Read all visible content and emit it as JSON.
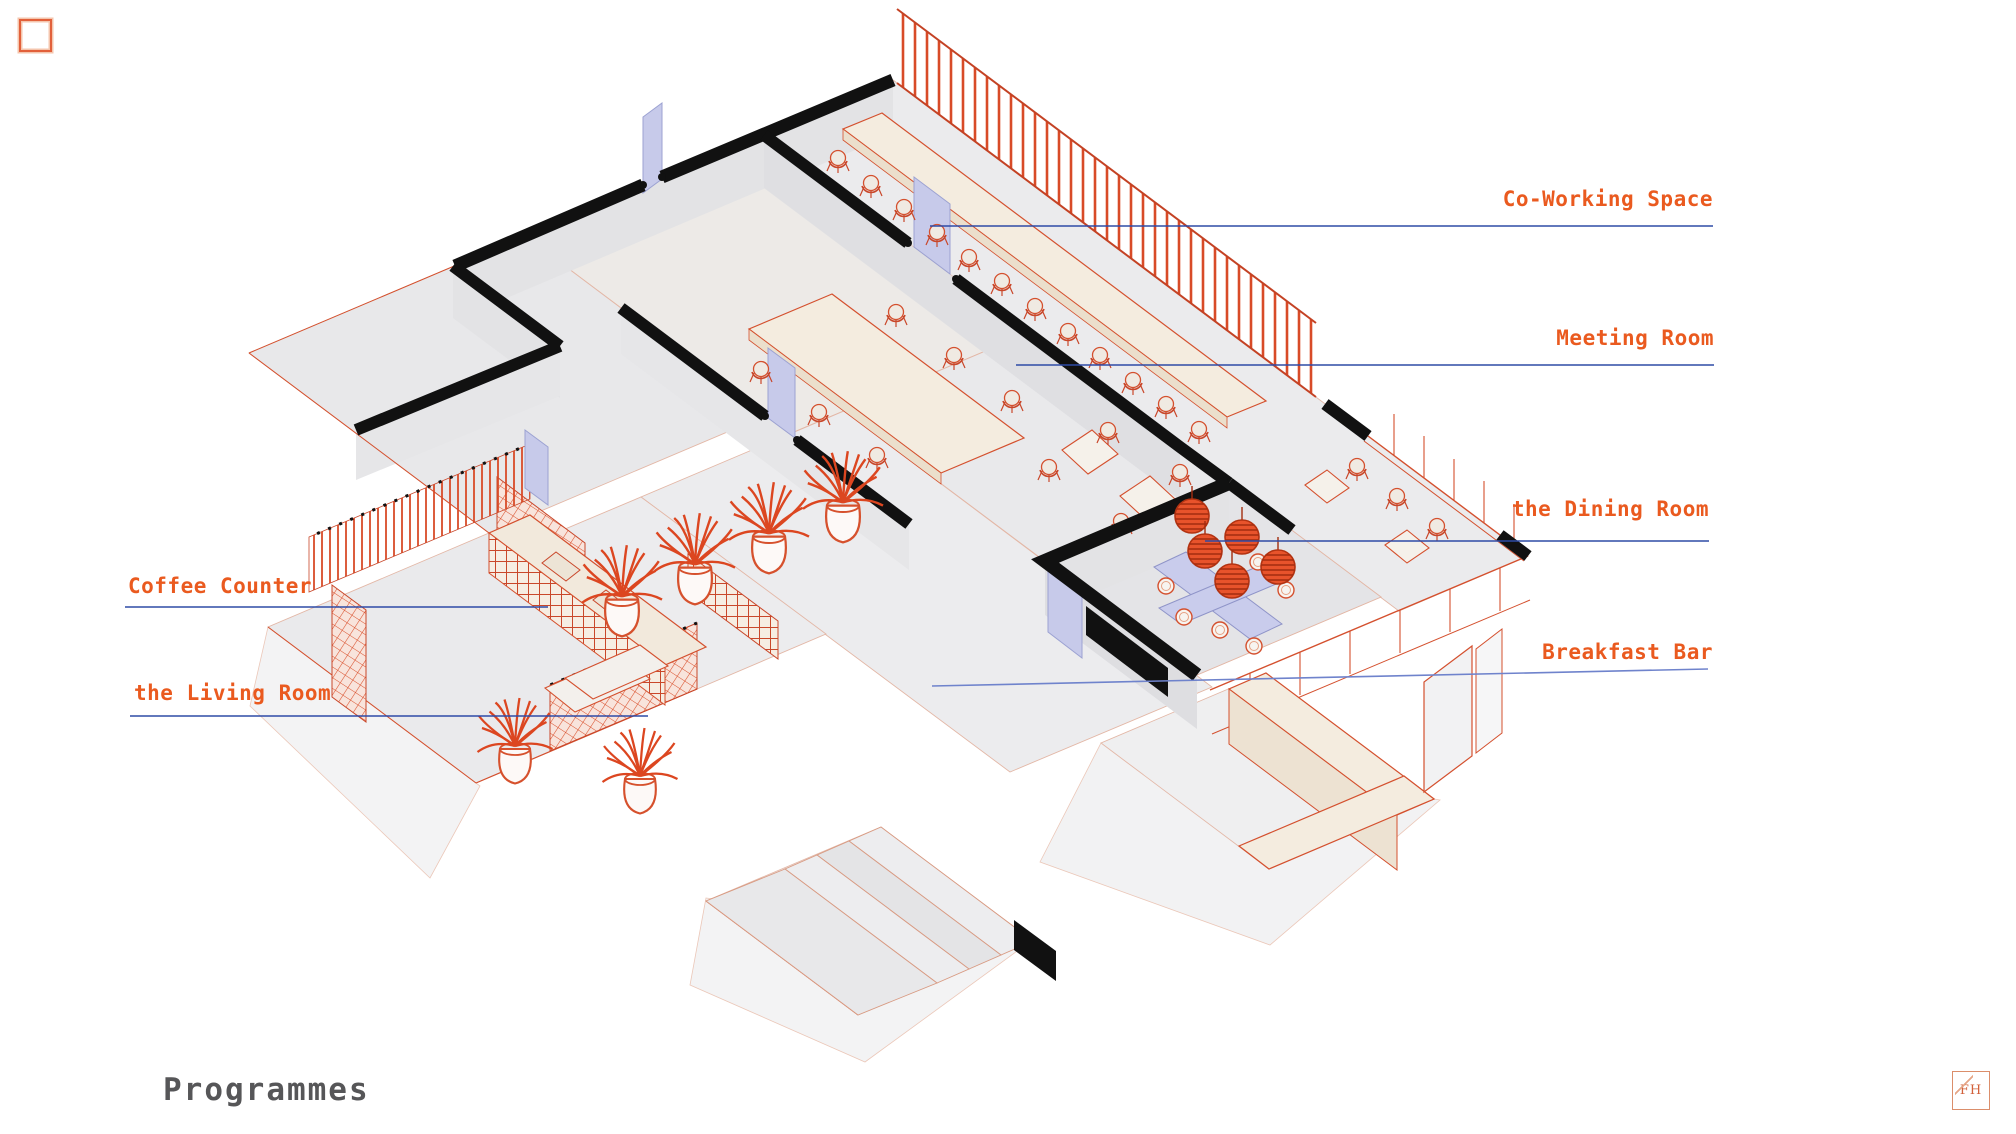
{
  "page": {
    "background": "#FFFFFF"
  },
  "annotations": {
    "coworking": "Co-Working Space",
    "meeting": "Meeting Room",
    "dining": "the Dining Room",
    "breakfast": "Breakfast Bar",
    "coffee": "Coffee Counter",
    "living": "the Living Room"
  },
  "title": "Programmes",
  "logo": {
    "monogram": "FH"
  },
  "colors": {
    "label_orange": "#EA5A1F",
    "title_gray": "#565658",
    "leader_blue": "#2E4BA6",
    "leader_blue_light": "#6F83CC",
    "wall_black": "#111111",
    "line_red": "#D4502E",
    "lavender": "#C7CAEA",
    "cream": "#F4ECDF",
    "floor_gray": "#E9E9EB",
    "plant_red": "#DC4620"
  }
}
